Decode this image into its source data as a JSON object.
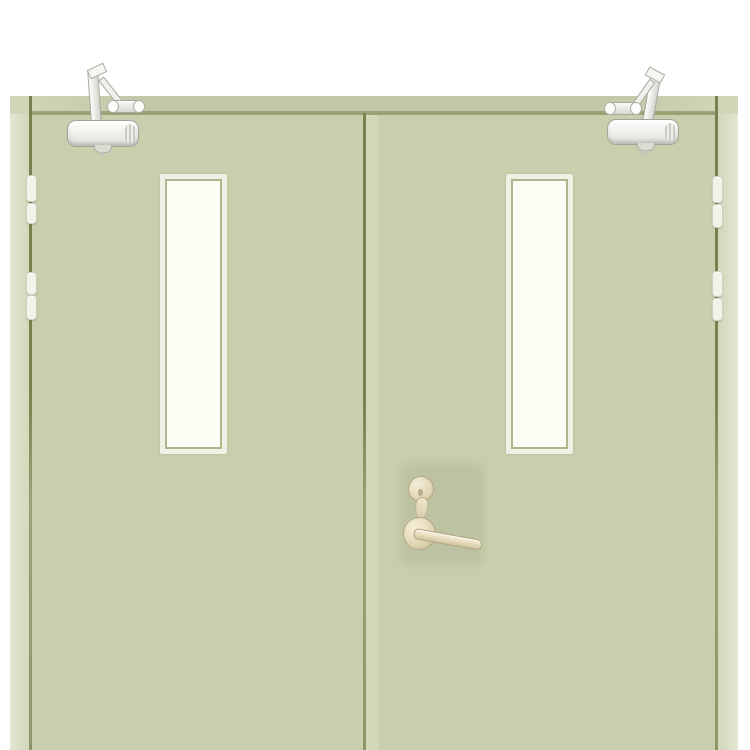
{
  "scene": {
    "description": "Product photo of a pale sage green double-leaf steel fire door: two narrow vertical vision panels with white frames, an overhead door closer on each leaf, two pairs of hinge knuckles on each outer jamb, and a champagne cylinder lock with lever handle on the right leaf",
    "leaf_count": 2,
    "vision_panel_count": 2,
    "door_closer_count": 2,
    "hinge_knuckle_count": 8
  },
  "parts": {
    "left_leaf": "left door leaf",
    "right_leaf": "right door leaf",
    "left_closer": "overhead door closer on left leaf",
    "right_closer": "overhead door closer on right leaf",
    "lockset": "cylinder lock and lever handle on right leaf",
    "left_vision_panel": "vision panel on left leaf",
    "right_vision_panel": "vision panel on right leaf"
  },
  "colors": {
    "background": "#ffffff",
    "door": "#c9cfad",
    "door_edge_highlight": "#d4d9b8",
    "frame_jamb_light": "#e3e6d1",
    "frame_jamb": "#d2d6b9",
    "frame_band": "#c2c7a7",
    "gap_dark": "#788050",
    "gap_soft": "#9aa275",
    "window_frame": "#f1f0e6",
    "window_line": "#aeb68c",
    "glass": "#fdfcf4",
    "metal_light": "#fbfbf9",
    "metal_mid": "#dededa",
    "metal_border": "#a3a39b",
    "brass_light": "#f4edd8",
    "brass_mid": "#d9cda9",
    "brass_border": "#b3a783",
    "shadow_tint": "rgba(110,118,82,0.12)"
  }
}
